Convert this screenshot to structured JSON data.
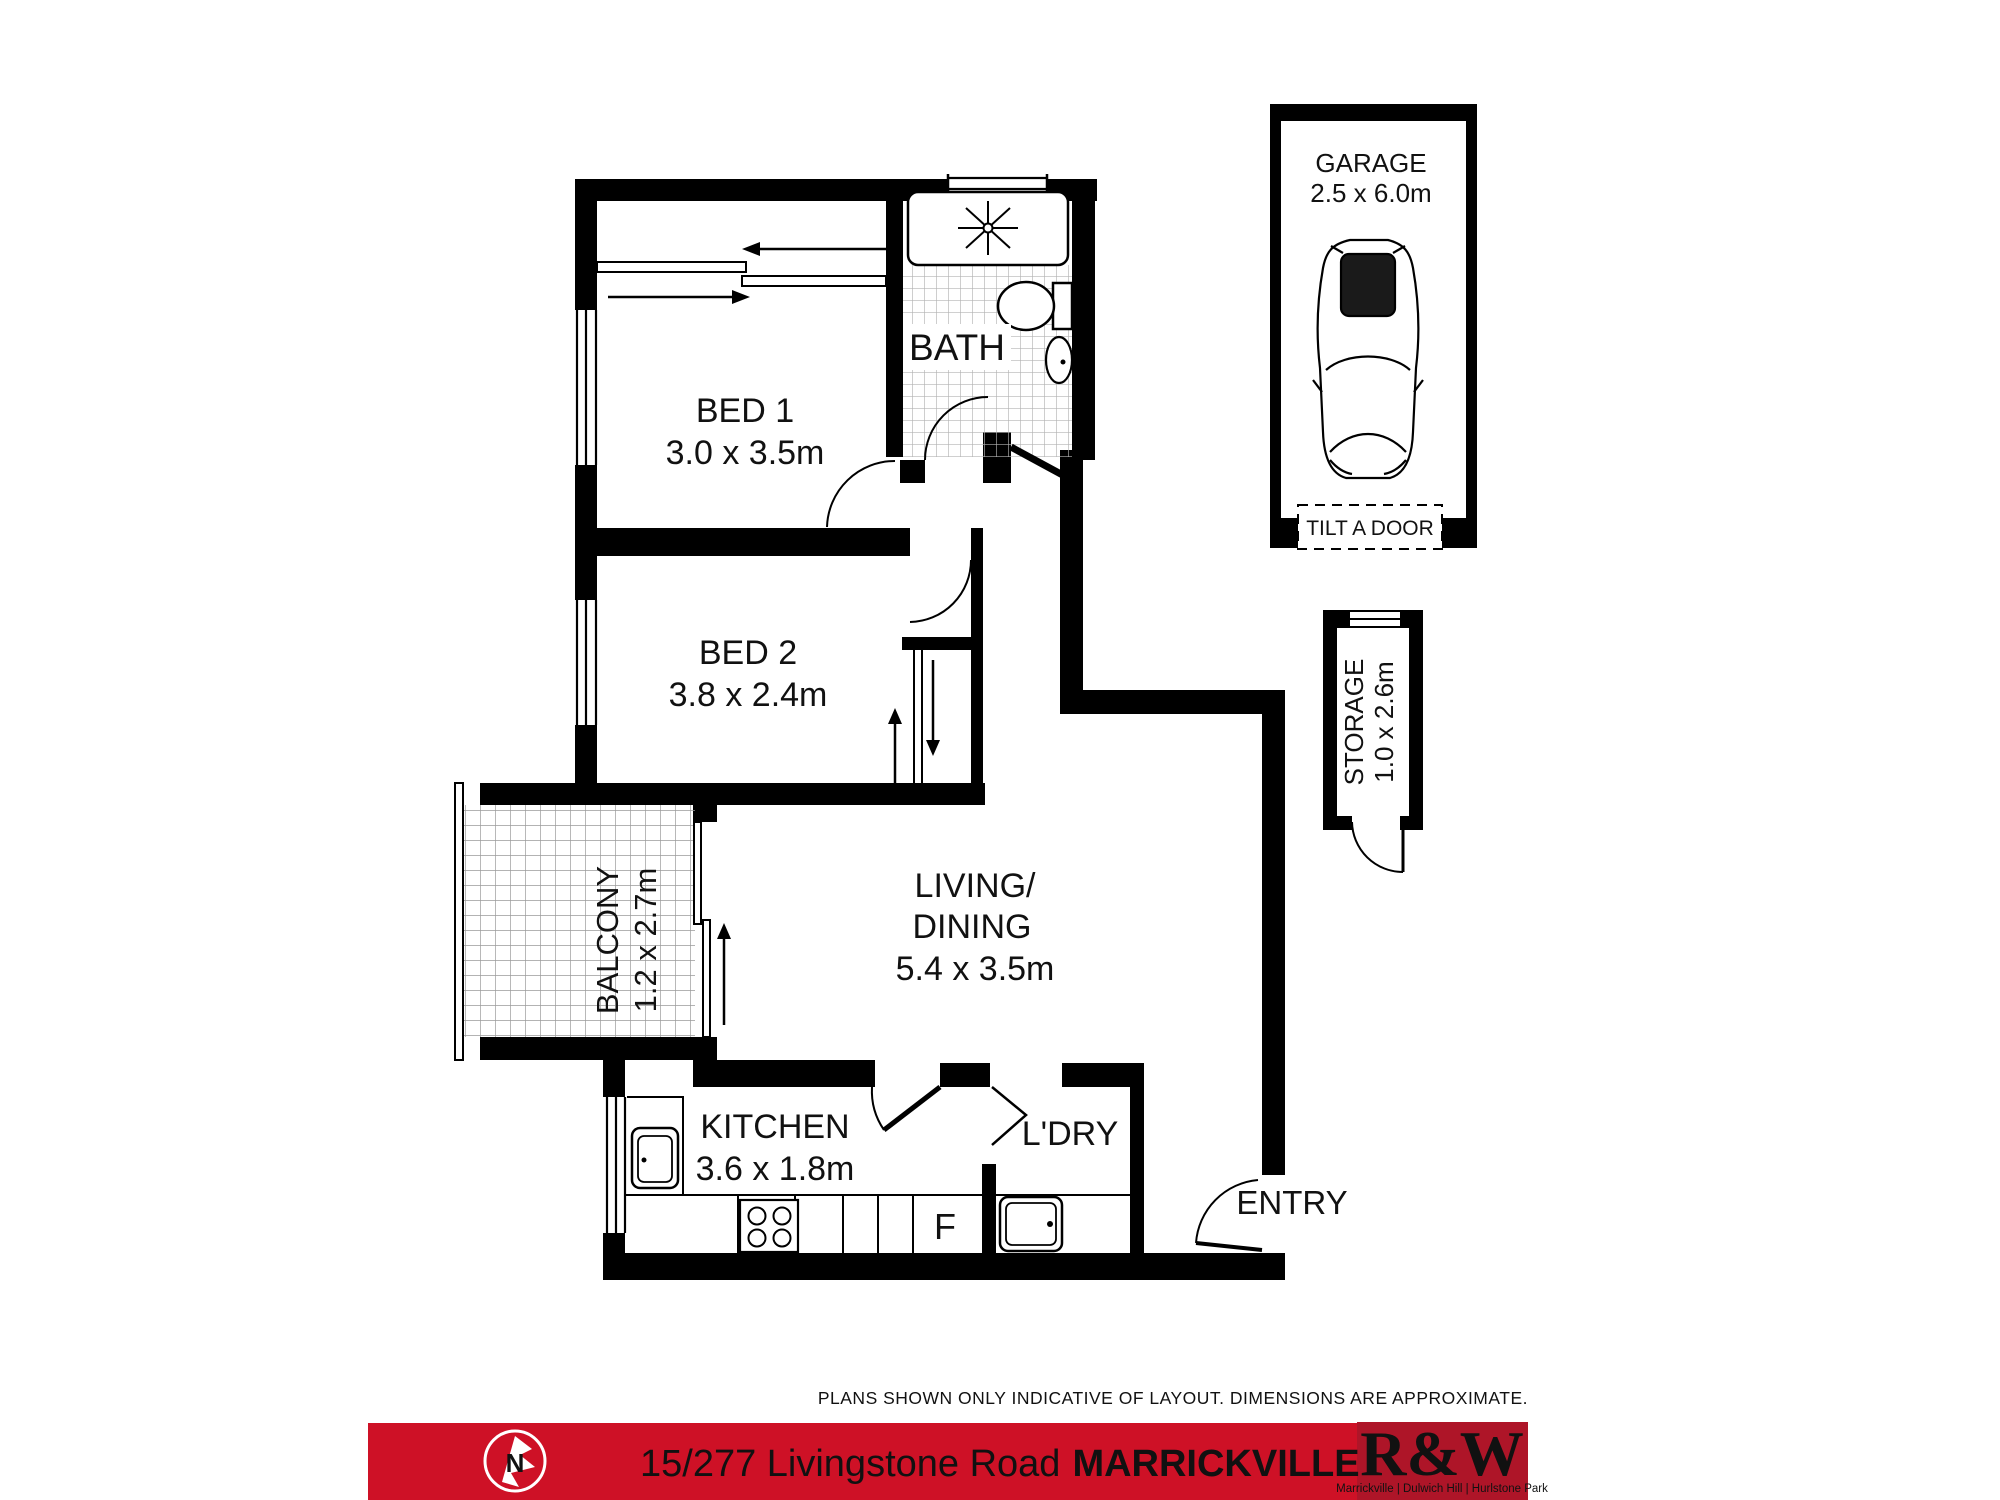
{
  "plan": {
    "rooms": {
      "bed1": {
        "name": "BED 1",
        "dims": "3.0 x 3.5m"
      },
      "bed2": {
        "name": "BED 2",
        "dims": "3.8 x 2.4m"
      },
      "bath": {
        "name": "BATH"
      },
      "living": {
        "name_line1": "LIVING/",
        "name_line2": "DINING",
        "dims": "5.4 x 3.5m"
      },
      "kitchen": {
        "name": "KITCHEN",
        "dims": "3.6 x 1.8m"
      },
      "laundry": {
        "name": "L'DRY"
      },
      "entry": {
        "name": "ENTRY"
      },
      "balcony": {
        "name": "BALCONY",
        "dims": "1.2 x 2.7m"
      },
      "garage": {
        "name": "GARAGE",
        "dims": "2.5 x 6.0m",
        "door_label": "TILT A DOOR"
      },
      "storage": {
        "name": "STORAGE",
        "dims": "1.0 x 2.6m"
      },
      "fridge_label": "F"
    }
  },
  "footer": {
    "disclaimer": "PLANS SHOWN ONLY INDICATIVE OF LAYOUT. DIMENSIONS ARE APPROXIMATE.",
    "address": {
      "street": "15/277 Livingstone Road",
      "suburb": "MARRICKVILLE"
    },
    "agency": {
      "logo": "R&W",
      "offices": "Marrickville | Dulwich Hill | Hurlstone Park",
      "north_letter": "N"
    },
    "colors": {
      "bar_red": "#CE1126",
      "logo_red": "#AE1528"
    }
  }
}
